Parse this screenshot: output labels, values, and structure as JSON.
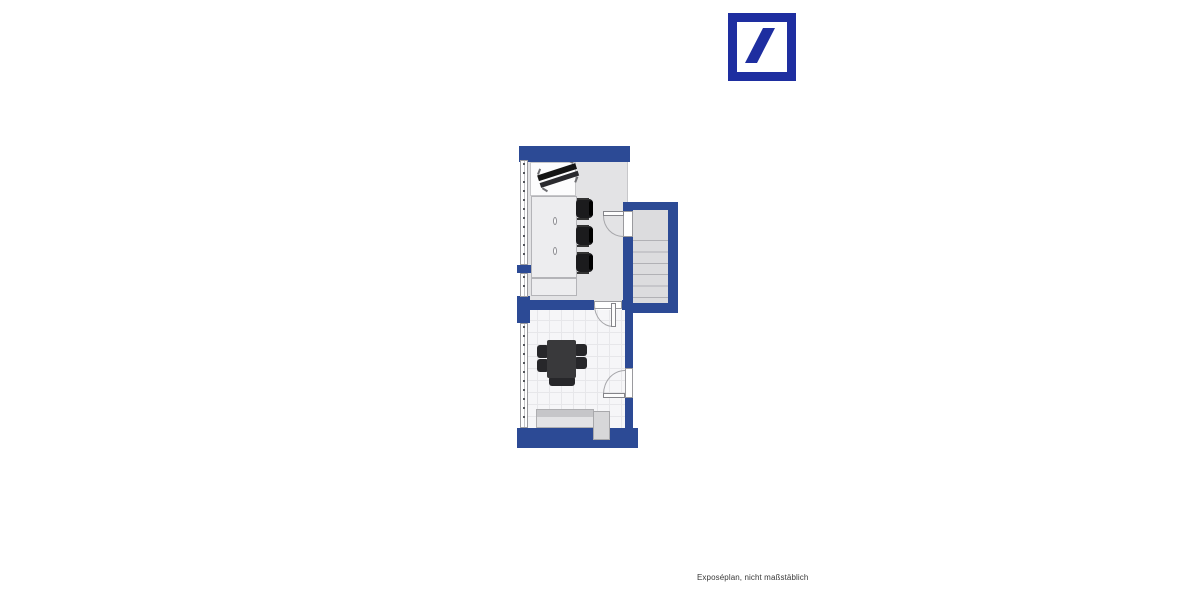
{
  "page": {
    "background": "#FFFFFF"
  },
  "logo": {
    "name": "deutsche-bank-logo",
    "color": "#1E2EA0"
  },
  "floorplan": {
    "wall_color": "#2C4A95",
    "floor_upper_color": "#E3E3E5",
    "floor_tile_color": "#F6F6F8",
    "stair_color": "#DCDCDE",
    "rooms": [
      "office-upper",
      "stairwell",
      "office-lower"
    ],
    "stair_step_lines": 6,
    "door_count": 3,
    "window_count": 3,
    "furniture": [
      "desk",
      "desk-chair-diagonal",
      "cabinet-tall",
      "cabinet-low",
      "office-chair",
      "office-chair",
      "office-chair",
      "meeting-table",
      "chair",
      "chair",
      "chair",
      "chair",
      "chair",
      "sideboard",
      "counter-block"
    ]
  },
  "credit": {
    "text": "Exposéplan, nicht maßstäblich"
  }
}
